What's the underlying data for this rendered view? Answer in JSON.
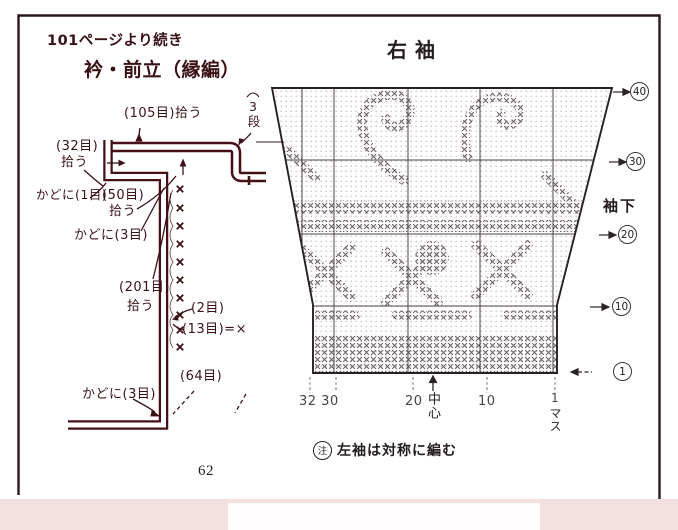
{
  "page": {
    "continuation_note": "101ページより続き",
    "page_number": "62"
  },
  "collar": {
    "title": "衿・前立（縁編）",
    "pickup_top": "(105目)拾う",
    "rows_label": "3段",
    "pickup_left_line1": "(32目)",
    "pickup_left_line2": "拾う",
    "corner_one": "かどに(1目)",
    "pickup_50_line1": "(50目)",
    "pickup_50_line2": "拾う",
    "corner_three_top": "かどに(3目)",
    "pickup_201_line1": "(201目)",
    "pickup_201_line2": "拾う",
    "sts_two": "(2目)",
    "sts_thirteen": "(13目)=",
    "sts_thirteen_mark": "×",
    "sts_sixtyfour": "(64目)",
    "corner_three_bottom": "かどに(3目)"
  },
  "sleeve": {
    "title": "右袖",
    "underarm_label": "袖下",
    "row_markers": [
      {
        "value": "40"
      },
      {
        "value": "30"
      },
      {
        "value": "20"
      },
      {
        "value": "10"
      },
      {
        "value": "1"
      }
    ],
    "stitch_labels": {
      "left": "32 30",
      "twenty": "20",
      "ten": "10",
      "one": "1"
    },
    "center_label": "中心",
    "unit_label": "マス",
    "note_mark": "注",
    "note_text": "左袖は対称に編む"
  },
  "colors": {
    "ink_maroon": "#3a1216",
    "chart_ink": "#2b2424",
    "tick_grey": "#4a4242",
    "margin_pink": "#f4dfdf",
    "paper": "#ffffff"
  }
}
